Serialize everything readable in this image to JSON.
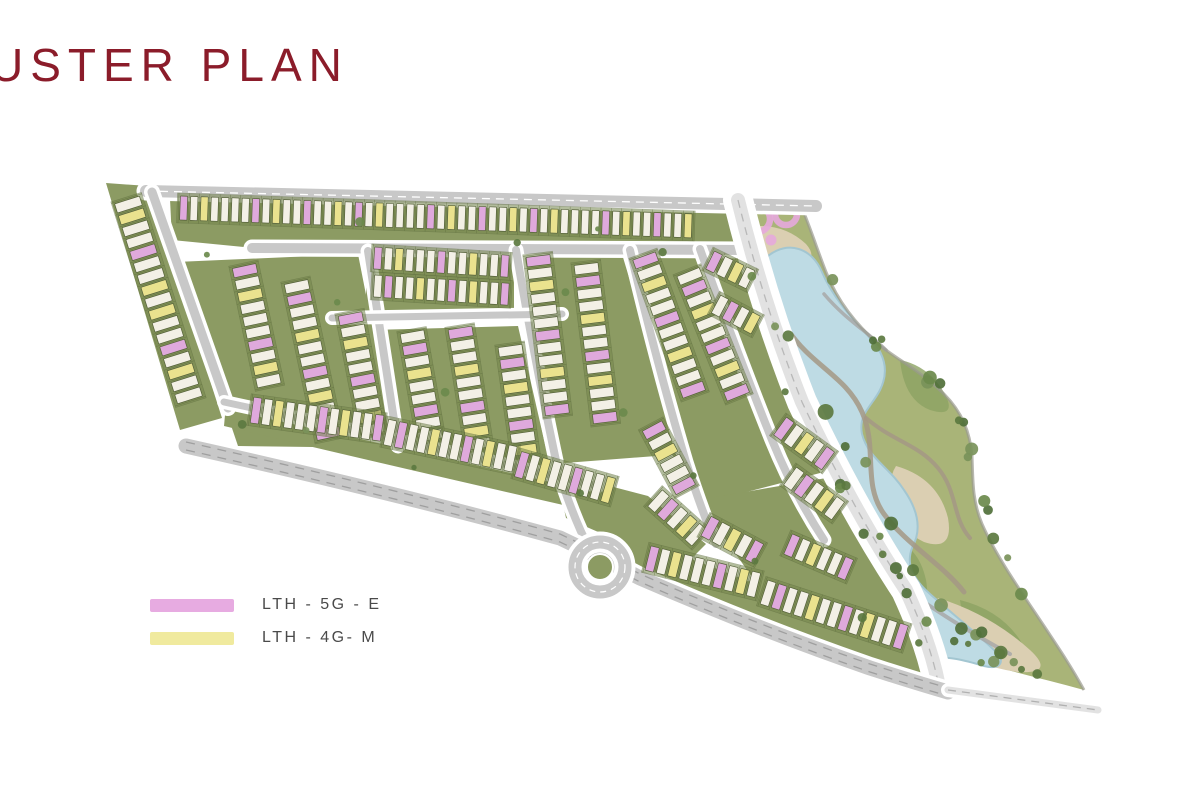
{
  "title": {
    "text": "USTER PLAN",
    "color": "#8b1c2a"
  },
  "legend": {
    "items": [
      {
        "label": "LTH - 5G - E",
        "swatch_color": "#e7abe1"
      },
      {
        "label": "LTH - 4G- M",
        "swatch_color": "#f0ea9e"
      }
    ]
  },
  "map": {
    "palette": {
      "block": "#8c9b63",
      "stripFill": "#75864d",
      "stripEdge": "#5d6c3d",
      "unitWhite": "#f3f0e6",
      "unitPink": "#dfa9dc",
      "unitYellow": "#eae28e",
      "unitStroke": "#55613a",
      "road": "#c8c8c8",
      "roadLight": "#e2e2e2",
      "parkGreen": "#a9b478",
      "parkGreenDark": "#8ca263",
      "sand": "#dbcfb2",
      "lake": "#bedbe4",
      "lakeEdge": "#a3c6d1",
      "pathBrown": "#a59885",
      "pathGray": "#a8a8a8",
      "trees": [
        "#5c7a40",
        "#6b8a4c",
        "#50703a",
        "#7a935a"
      ]
    },
    "blocks": [
      "106,183 148,186 222,418 180,430",
      "170,199 740,208 748,246 254,248 172,240",
      "366,252 514,252 514,314 366,316",
      "176,262 358,254 396,448 238,446",
      "372,330 518,326 550,466 402,456",
      "522,252 622,254 682,454 552,464",
      "634,252 742,252 800,414 824,472 700,504 662,436",
      "698,500 838,476 872,532 912,596 926,654 910,668 768,600",
      "M226,404 Q400,442 600,488 L594,512 Q400,468 224,426 Z",
      "M612,530 Q770,586 930,658 L922,684 Q762,618 604,554 Z",
      "556,472 648,496 706,544 688,562 612,538 566,518"
    ],
    "roads": [
      {
        "d": "M146,191 L816,206",
        "w": 12,
        "dash": "#ffffff"
      },
      {
        "d": "M252,248 L746,250",
        "w": 10
      },
      {
        "d": "M152,192 L228,408",
        "w": 9
      },
      {
        "d": "M368,251 L398,446",
        "w": 8
      },
      {
        "d": "M516,250 Q536,368 558,470 Q574,520 590,550",
        "w": 8
      },
      {
        "d": "M630,250 Q658,368 686,462 Q702,512 716,544",
        "w": 8
      },
      {
        "d": "M700,249 Q736,350 772,440 Q794,494 824,540",
        "w": 8
      },
      {
        "d": "M332,318 L562,314",
        "w": 7
      },
      {
        "d": "M224,402 Q400,440 598,486",
        "w": 7
      },
      {
        "d": "M738,200 Q764,306 802,402 Q852,508 906,590 Q930,642 938,682",
        "w": 14,
        "light": 1,
        "casing": 30,
        "dash": "#b8b8b8"
      },
      {
        "d": "M186,446 Q400,494 560,538 Q598,556 640,578 Q760,630 870,668 Q920,684 948,692",
        "w": 15,
        "dash2": 1
      },
      {
        "d": "M948,690 L1098,710",
        "w": 7,
        "light": 1,
        "dash": "#b0b0b0"
      }
    ],
    "roundabout": [
      600,
      567
    ],
    "rows": [
      [
        127,
        200,
        72.5,
        17,
        9.5,
        26,
        "wywwpwwywywwpwyww"
      ],
      [
        180,
        208,
        2,
        50,
        7.3,
        24,
        "pwywwwwpwywwpwwyw"
      ],
      [
        374,
        258,
        3.5,
        13,
        7.6,
        22,
        "pwywwwpwwywwp"
      ],
      [
        374,
        286,
        3.5,
        13,
        7.6,
        22,
        "wpwwywwpwywwp"
      ],
      [
        244,
        266,
        78,
        10,
        9.5,
        24,
        "pwywwwpwyw"
      ],
      [
        296,
        282,
        78,
        13,
        9.5,
        24,
        "wpwwywwpwywwp"
      ],
      [
        350,
        314,
        79,
        10,
        9.5,
        24,
        "pwywwpwwyw"
      ],
      [
        412,
        332,
        80,
        9,
        9.5,
        24,
        "wpwywwpww"
      ],
      [
        460,
        328,
        81,
        10,
        9.5,
        24,
        "pwwywwpwyw"
      ],
      [
        510,
        346,
        82,
        9,
        9.5,
        24,
        "wpwywwpwy"
      ],
      [
        538,
        256,
        83,
        13,
        9.5,
        24,
        "pwywwwpwwywwp"
      ],
      [
        586,
        264,
        83,
        13,
        9.5,
        24,
        "wpwwywwpwywwp"
      ],
      [
        644,
        256,
        70,
        12,
        9.5,
        24,
        "pwywwpwwywwp"
      ],
      [
        688,
        272,
        68,
        11,
        9.5,
        24,
        "wpwywwpwywp"
      ],
      [
        710,
        260,
        26,
        4,
        9,
        20,
        "pwyw"
      ],
      [
        716,
        304,
        28,
        4,
        9,
        20,
        "wpwy"
      ],
      [
        780,
        426,
        36,
        5,
        9.5,
        22,
        "pwywp"
      ],
      [
        790,
        476,
        36,
        5,
        9.5,
        22,
        "wpwyw"
      ],
      [
        652,
        426,
        62,
        6,
        9.5,
        22,
        "pwywwp"
      ],
      [
        655,
        498,
        42,
        5,
        9.5,
        22,
        "wpwyw"
      ],
      [
        706,
        526,
        28,
        5,
        9.5,
        22,
        "pwywp"
      ],
      [
        252,
        410,
        8,
        12,
        8.2,
        26,
        "pwywwwpwywwp"
      ],
      [
        386,
        432,
        12,
        12,
        8.2,
        26,
        "wpwwywwpwyww"
      ],
      [
        518,
        464,
        16,
        9,
        8.2,
        26,
        "pwywwpwwy"
      ],
      [
        648,
        558,
        14,
        10,
        8.6,
        25,
        "pwywwwpwyw"
      ],
      [
        764,
        592,
        18,
        13,
        8.6,
        25,
        "wpwwywwpwywwp"
      ],
      [
        788,
        544,
        23,
        6,
        8.6,
        22,
        "pwywwp"
      ]
    ],
    "park": {
      "outline": "M742,202 L800,203 C812,232 818,252 826,272 C838,302 856,324 878,344 C898,360 922,372 944,394 C962,412 970,432 972,456 C973,480 972,500 982,524 C996,556 1020,590 1044,626 C1060,650 1072,668 1084,690 C1040,678 996,668 966,658 C944,650 930,634 918,612 C900,580 882,552 864,524 C846,496 828,466 812,436 C796,406 784,374 774,342 C764,310 754,272 748,240 C745,226 743,214 742,202 Z",
      "rightEdge": "M800,203 C812,232 818,252 826,272 C838,302 856,324 878,344 C898,360 922,372 944,394 C962,412 970,432 972,456 C973,480 972,500 982,524 C996,556 1020,590 1044,626 C1060,650 1072,668 1084,690",
      "patches": [
        "M760,300 Q790,290 796,330 Q800,370 776,360 Q754,348 760,300 Z",
        "M830,440 Q856,440 862,480 Q866,520 842,508 Q820,494 830,440 Z",
        "M890,540 Q918,544 926,580 Q932,616 906,604 Q884,590 890,540 Z",
        "M960,600 Q1000,610 1020,640 Q1034,662 1000,656 Q966,648 960,600 Z",
        "M900,360 Q930,366 946,396 Q956,418 930,410 Q904,400 900,360 Z"
      ],
      "sand": [
        "M742,228 Q780,220 806,244 Q820,260 798,268 Q764,276 750,260 Q738,244 742,228 Z",
        "M896,466 Q938,478 948,518 Q954,552 924,542 Q898,530 892,500 Q888,478 896,466 Z",
        "M938,598 Q990,614 1030,650 Q1056,674 1018,672 Q972,666 948,642 Q928,618 938,598 Z"
      ],
      "lake": "M768,256 C788,240 812,248 822,272 C832,296 850,316 868,336 C884,352 890,370 880,390 C872,406 858,414 862,434 C868,458 890,468 904,490 C918,510 922,530 912,548 C906,564 912,578 930,594 C950,612 976,632 996,652 C1006,662 1000,670 984,666 C964,660 948,656 932,658 C914,660 900,646 888,624 C878,604 872,584 860,562 C848,540 836,520 830,496 C822,470 816,444 806,418 C796,392 782,364 772,336 C762,310 756,280 768,256 Z",
      "paths": [
        {
          "d": "M788,330 C812,366 846,376 862,412 C878,448 862,484 884,514 C906,544 942,564 964,592",
          "w": 5,
          "c": "brown"
        },
        {
          "d": "M824,294 C846,320 868,332 886,350",
          "w": 3.5,
          "c": "gray"
        },
        {
          "d": "M866,418 C894,442 918,444 938,468 C958,492 952,518 970,538",
          "w": 4,
          "c": "brown"
        },
        {
          "d": "M918,598 C950,620 980,638 1010,654",
          "w": 4,
          "c": "gray"
        }
      ],
      "pink": {
        "color": "#e5a8db",
        "rings": [
          [
            757,
            219,
            13
          ],
          [
            786,
            214,
            11
          ]
        ],
        "blob": [
          771,
          240,
          5.5
        ]
      }
    },
    "trees": [
      {
        "seed": 7,
        "n": 14,
        "r": [
          3,
          6.5
        ],
        "pts": [
          [
            752,
            250
          ],
          [
            768,
            320
          ],
          [
            795,
            395
          ],
          [
            830,
            460
          ],
          [
            862,
            515
          ],
          [
            900,
            580
          ],
          [
            928,
            640
          ]
        ]
      },
      {
        "seed": 11,
        "n": 16,
        "r": [
          3.5,
          7
        ],
        "pts": [
          [
            812,
            215
          ],
          [
            838,
            290
          ],
          [
            880,
            340
          ],
          [
            930,
            380
          ],
          [
            962,
            425
          ],
          [
            972,
            490
          ],
          [
            1000,
            550
          ],
          [
            1040,
            610
          ],
          [
            1075,
            665
          ]
        ]
      },
      {
        "seed": 23,
        "n": 11,
        "r": [
          4,
          8
        ],
        "pts": [
          [
            790,
            320
          ],
          [
            830,
            420
          ],
          [
            870,
            480
          ],
          [
            900,
            540
          ],
          [
            950,
            620
          ],
          [
            1000,
            655
          ]
        ]
      },
      {
        "seed": 31,
        "n": 16,
        "r": [
          2.5,
          5
        ],
        "scatter": 1,
        "pts": [
          [
            200,
            250
          ],
          [
            300,
            430
          ],
          [
            340,
            300
          ],
          [
            420,
            460
          ],
          [
            450,
            400
          ],
          [
            520,
            250
          ],
          [
            560,
            300
          ],
          [
            580,
            500
          ],
          [
            620,
            420
          ],
          [
            660,
            250
          ],
          [
            700,
            480
          ],
          [
            760,
            560
          ],
          [
            860,
            610
          ],
          [
            240,
            420
          ],
          [
            360,
            225
          ],
          [
            600,
            222
          ]
        ]
      },
      {
        "seed": 41,
        "n": 8,
        "r": [
          3,
          6
        ],
        "pts": [
          [
            954,
            636
          ],
          [
            986,
            656
          ],
          [
            1018,
            670
          ],
          [
            1052,
            680
          ]
        ]
      }
    ]
  }
}
